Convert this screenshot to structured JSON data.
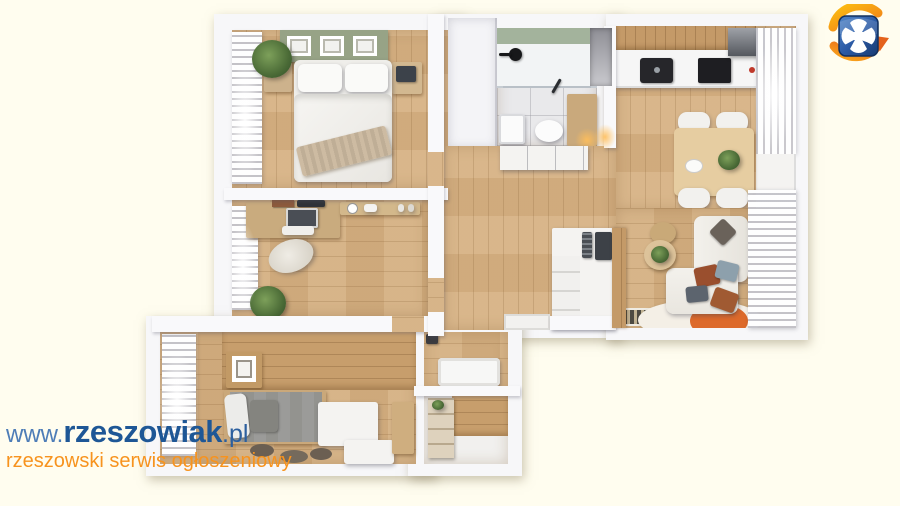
{
  "watermark": {
    "prefix": "www.",
    "brand": "rzeszowiak",
    "suffix": ".pl",
    "tagline": "rzeszowski serwis ogłoszeniowy",
    "prefix_color": "#4e7db7",
    "brand_color": "#1e5796",
    "tagline_color": "#f7931e"
  },
  "logo": {
    "name": "rzeszowiak-shield-logo",
    "shield_color": "#2f5fa8",
    "cross_color": "#ffffff",
    "swoosh_color": "#f5941f"
  },
  "scene": {
    "type": "3d-apartment-floor-plan-render",
    "background_color": "#fffdef",
    "wall_color": "#f8f8fa",
    "floor_wood_color": "#d7b284",
    "headboard_green": "#97a386",
    "rug_orange": "#dd6a2b"
  }
}
